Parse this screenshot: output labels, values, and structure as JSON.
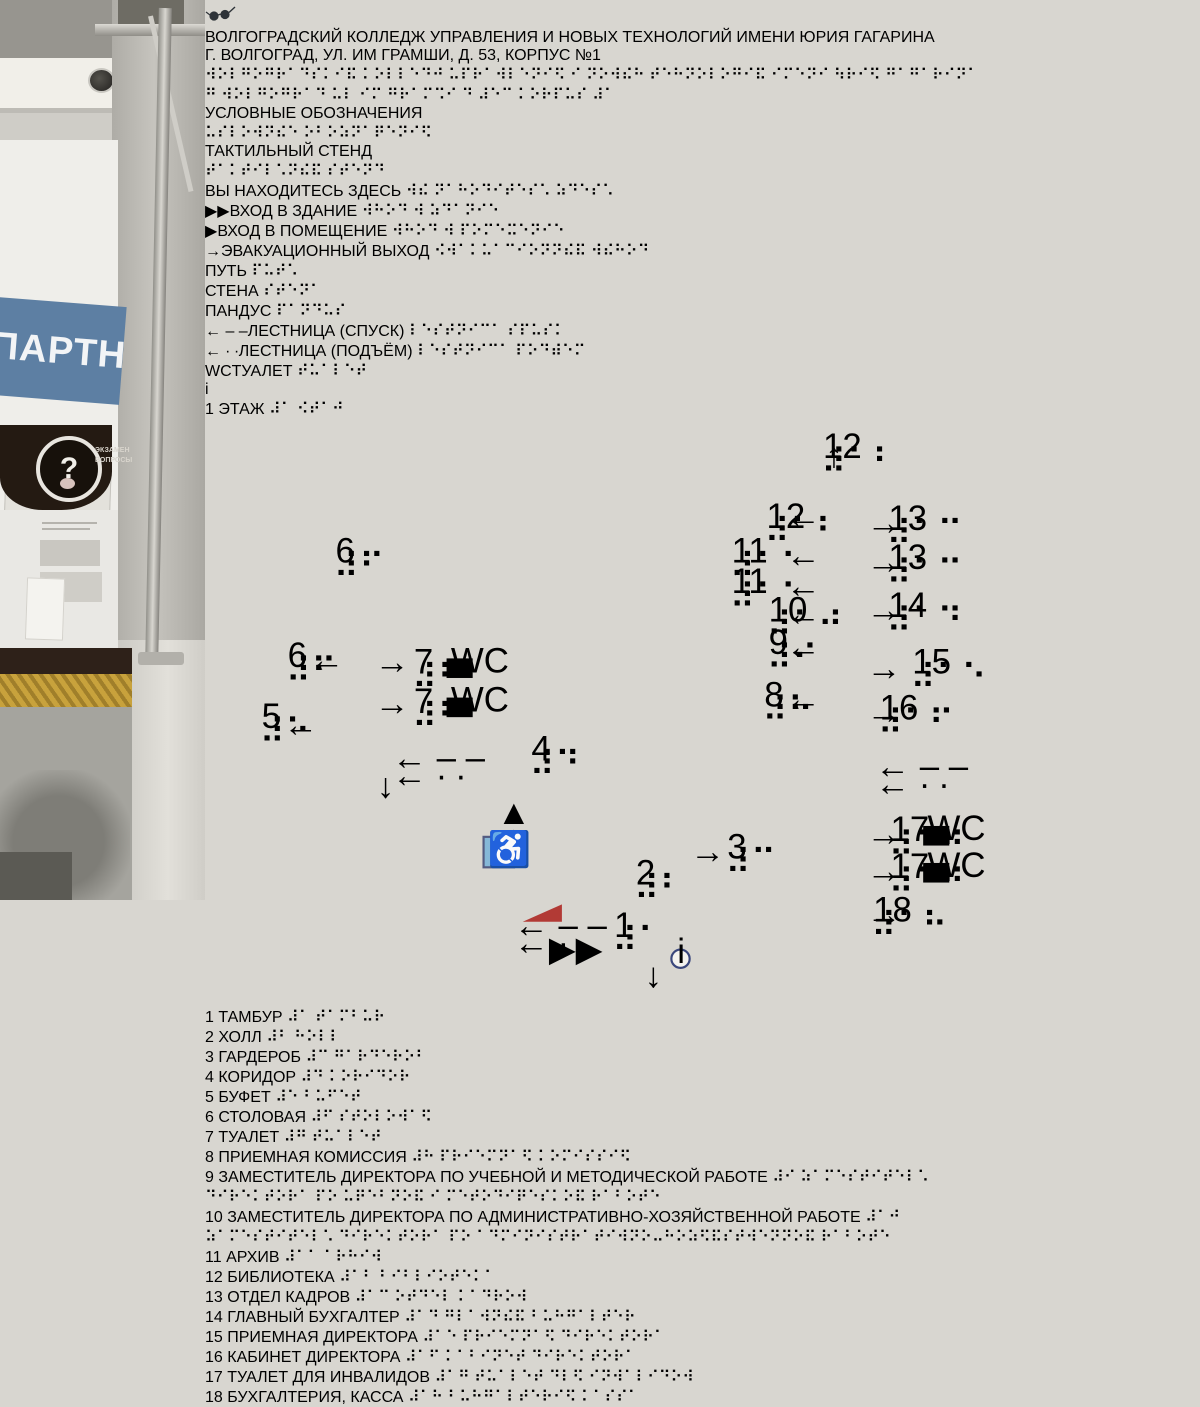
{
  "scene": {
    "partner_title": "ПАРТНЕРЫ",
    "partner_sub": "«ВГАЗ-СУАЛ» АО «СУАЛ»",
    "qmark": "?",
    "exam_line1": "ЭКЗАМЕН",
    "exam_line2": "ВОПРОСЫ"
  },
  "sign": {
    "colors": {
      "accent_red": "#b0362f",
      "navy": "#3a477c",
      "path_red": "#b23a35"
    },
    "title_line1": "ВОЛГОГРАДСКИЙ КОЛЛЕДЖ УПРАВЛЕНИЯ И НОВЫХ ТЕХНОЛОГИЙ ИМЕНИ ЮРИЯ ГАГАРИНА",
    "title_line2": "Г. ВОЛГОГРАД, УЛ. ИМ ГРАМШИ, Д. 53, КОРПУС №1",
    "title_braille1": "⠺⠕⠇⠛⠕⠛⠗⠁⠙⠎⠅⠊⠯ ⠅⠕⠇⠇⠑⠙⠚ ⠥⠏⠗⠁⠺⠇⠑⠝⠊⠫ ⠊ ⠝⠕⠺⠮⠓ ⠞⠑⠓⠝⠕⠇⠕⠛⠊⠯ ⠊⠍⠑⠝⠊ ⠳⠗⠊⠫ ⠛⠁⠛⠁⠗⠊⠝⠁",
    "title_braille2": "⠛ ⠺⠕⠇⠛⠕⠛⠗⠁⠙ ⠥⠇ ⠊⠍ ⠛⠗⠁⠍⠩⠊ ⠙ ⠼⠑⠉ ⠅⠕⠗⠏⠥⠎ ⠼⠁",
    "legend": {
      "heading": "УСЛОВНЫЕ ОБОЗНАЧЕНИЯ",
      "heading_braille": "⠥⠎⠇⠕⠺⠝⠮⠑ ⠕⠃⠕⠵⠝⠁⠟⠑⠝⠊⠫",
      "stand_label": "ТАКТИЛЬНЫЙ СТЕНД",
      "stand_braille": "⠞⠁⠅⠞⠊⠇⠡⠝⠮⠯ ⠎⠞⠑⠝⠙",
      "info_glyph": "i",
      "items": [
        {
          "cls": "ty-none",
          "icon": "",
          "label": "ВЫ НАХОДИТЕСЬ ЗДЕСЬ",
          "braille": "⠺⠮ ⠝⠁⠓⠕⠙⠊⠞⠑⠎⠡ ⠵⠙⠑⠎⠡"
        },
        {
          "cls": "ty-red",
          "icon": "▶▶",
          "label": "ВХОД В ЗДАНИЕ",
          "braille": "⠺⠓⠕⠙ ⠺ ⠵⠙⠁⠝⠊⠑"
        },
        {
          "cls": "ty-red",
          "icon": "▶",
          "label": "ВХОД В ПОМЕЩЕНИЕ",
          "braille": "⠺⠓⠕⠙ ⠺ ⠏⠕⠍⠑⠭⠑⠝⠊⠑"
        },
        {
          "cls": "ty-red",
          "icon": "→",
          "label": "ЭВАКУАЦИОННЫЙ ВЫХОД",
          "braille": "⠪⠺⠁⠅⠥⠁⠉⠊⠕⠝⠝⠮⠯ ⠺⠮⠓⠕⠙"
        },
        {
          "cls": "ty-dash inl",
          "icon": "",
          "label": "ПУТЬ",
          "braille": "⠏⠥⠞⠡"
        },
        {
          "cls": "ty-wall inl",
          "icon": "",
          "label": "СТЕНА",
          "braille": "⠎⠞⠑⠝⠁"
        },
        {
          "cls": "ty-ramp inl",
          "icon": "",
          "label": "ПАНДУС",
          "braille": "⠏⠁⠝⠙⠥⠎"
        },
        {
          "cls": "ty-navy",
          "icon": "← – –",
          "label": "ЛЕСТНИЦА (СПУСК)",
          "braille": "⠇⠑⠎⠞⠝⠊⠉⠁ ⠎⠏⠥⠎⠅"
        },
        {
          "cls": "ty-navy",
          "icon": "← ∙ ∙",
          "label": "ЛЕСТНИЦА (ПОДЪЁМ)",
          "braille": "⠇⠑⠎⠞⠝⠊⠉⠁ ⠏⠕⠙⠾⠑⠍"
        },
        {
          "cls": "ty-wc inl",
          "icon": "WC",
          "label": "ТУАЛЕТ",
          "braille": "⠞⠥⠁⠇⠑⠞"
        }
      ]
    },
    "plan": {
      "title": "1 ЭТАЖ",
      "title_braille": "⠼⠁ ⠪⠞⠁⠚",
      "wc": "WC",
      "rooms": [
        {
          "n": "6",
          "b": "⠼⠋",
          "x": 60,
          "y": 66
        },
        {
          "n": "6",
          "b": "⠼⠋",
          "x": 38,
          "y": 114
        },
        {
          "n": "5",
          "b": "⠼⠑",
          "x": 26,
          "y": 142
        },
        {
          "n": "7",
          "b": "⠼⠛",
          "x": 96,
          "y": 117,
          "wc": 1
        },
        {
          "n": "7",
          "b": "⠼⠛",
          "x": 96,
          "y": 135,
          "wc": 1
        },
        {
          "n": "4",
          "b": "⠼⠙",
          "x": 150,
          "y": 157
        },
        {
          "n": "3",
          "b": "⠼⠉",
          "x": 240,
          "y": 202
        },
        {
          "n": "2",
          "b": "⠼⠃",
          "x": 198,
          "y": 214
        },
        {
          "n": "1",
          "b": "⠼⠁",
          "x": 188,
          "y": 238
        },
        {
          "n": "12",
          "b": "⠼⠁⠃",
          "x": 284,
          "y": 18
        },
        {
          "n": "12",
          "b": "⠼⠁⠃",
          "x": 258,
          "y": 50
        },
        {
          "n": "11",
          "b": "⠼⠁⠁",
          "x": 242,
          "y": 66
        },
        {
          "n": "11",
          "b": "⠼⠁⠁",
          "x": 242,
          "y": 80
        },
        {
          "n": "10",
          "b": "⠼⠁⠚",
          "x": 259,
          "y": 93
        },
        {
          "n": "9",
          "b": "⠼⠊",
          "x": 259,
          "y": 108
        },
        {
          "n": "8",
          "b": "⠼⠓",
          "x": 257,
          "y": 132
        },
        {
          "n": "13",
          "b": "⠼⠁⠉",
          "x": 314,
          "y": 51
        },
        {
          "n": "13",
          "b": "⠼⠁⠉",
          "x": 314,
          "y": 69
        },
        {
          "n": "14",
          "b": "⠼⠁⠙",
          "x": 314,
          "y": 91
        },
        {
          "n": "15",
          "b": "⠼⠁⠑",
          "x": 325,
          "y": 117
        },
        {
          "n": "16",
          "b": "⠼⠁⠋",
          "x": 310,
          "y": 138
        },
        {
          "n": "17",
          "b": "⠼⠁⠛",
          "x": 315,
          "y": 194,
          "wc": 1
        },
        {
          "n": "17",
          "b": "⠼⠁⠛",
          "x": 315,
          "y": 211,
          "wc": 1
        },
        {
          "n": "18",
          "b": "⠼⠁⠓",
          "x": 307,
          "y": 231
        }
      ],
      "marks": [
        {
          "t": "→",
          "x": 78,
          "y": 117,
          "cls": "pl-red"
        },
        {
          "t": "→",
          "x": 78,
          "y": 136,
          "cls": "pl-red"
        },
        {
          "t": "←",
          "x": 48,
          "y": 116,
          "cls": "pl-red"
        },
        {
          "t": "←",
          "x": 36,
          "y": 146,
          "cls": "pl-red"
        },
        {
          "t": "←",
          "x": 267,
          "y": 50,
          "cls": "pl-red"
        },
        {
          "t": "←",
          "x": 267,
          "y": 68,
          "cls": "pl-red"
        },
        {
          "t": "←",
          "x": 267,
          "y": 82,
          "cls": "pl-red"
        },
        {
          "t": "←",
          "x": 267,
          "y": 95,
          "cls": "pl-red"
        },
        {
          "t": "←",
          "x": 267,
          "y": 110,
          "cls": "pl-red"
        },
        {
          "t": "←",
          "x": 267,
          "y": 134,
          "cls": "pl-red"
        },
        {
          "t": "→",
          "x": 304,
          "y": 53,
          "cls": "pl-red"
        },
        {
          "t": "→",
          "x": 304,
          "y": 71,
          "cls": "pl-red"
        },
        {
          "t": "→",
          "x": 304,
          "y": 93,
          "cls": "pl-red"
        },
        {
          "t": "→",
          "x": 304,
          "y": 120,
          "cls": "pl-red"
        },
        {
          "t": "→",
          "x": 304,
          "y": 140,
          "cls": "pl-red"
        },
        {
          "t": "→",
          "x": 304,
          "y": 196,
          "cls": "pl-red"
        },
        {
          "t": "→",
          "x": 304,
          "y": 213,
          "cls": "pl-red"
        },
        {
          "t": "→",
          "x": 304,
          "y": 233,
          "cls": "pl-red"
        },
        {
          "t": "↑",
          "x": 285,
          "y": 22,
          "cls": "pl-red"
        },
        {
          "t": "▲",
          "x": 134,
          "y": 186,
          "cls": "pl-red"
        },
        {
          "t": "▲",
          "x": 134,
          "y": 198,
          "cls": "pl-red"
        },
        {
          "t": "→",
          "x": 223,
          "y": 204,
          "cls": "pl-red"
        },
        {
          "t": "▶▶",
          "x": 158,
          "y": 249,
          "cls": "pl-red"
        },
        {
          "t": "← – –",
          "x": 86,
          "y": 161,
          "cls": "pl-mk"
        },
        {
          "t": "← ∙ ∙",
          "x": 86,
          "y": 169,
          "cls": "pl-mk"
        },
        {
          "t": "← – –",
          "x": 308,
          "y": 165,
          "cls": "pl-mk"
        },
        {
          "t": "← ∙ ∙",
          "x": 308,
          "y": 173,
          "cls": "pl-mk"
        },
        {
          "t": "← – –",
          "x": 142,
          "y": 238,
          "cls": "pl-mk"
        },
        {
          "t": "← ∙ ∙",
          "x": 142,
          "y": 246,
          "cls": "pl-mk"
        },
        {
          "t": "↓",
          "x": 79,
          "y": 174,
          "cls": "pl-mk"
        },
        {
          "t": "↓",
          "x": 202,
          "y": 261,
          "cls": "pl-mk"
        },
        {
          "t": "i",
          "x": 217,
          "y": 250,
          "cls": "pl-info-t"
        },
        {
          "t": "♿",
          "x": 130,
          "y": 203,
          "cls": "pl-wh"
        }
      ]
    },
    "rooms": {
      "col1": [
        {
          "n": "1",
          "l1": "ТАМБУР",
          "l2": "",
          "b1": "⠼⠁ ⠞⠁⠍⠃⠥⠗",
          "b2": ""
        },
        {
          "n": "2",
          "l1": "ХОЛЛ",
          "l2": "",
          "b1": "⠼⠃ ⠓⠕⠇⠇",
          "b2": ""
        },
        {
          "n": "3",
          "l1": "ГАРДЕРОБ",
          "l2": "",
          "b1": "⠼⠉ ⠛⠁⠗⠙⠑⠗⠕⠃",
          "b2": ""
        },
        {
          "n": "4",
          "l1": "КОРИДОР",
          "l2": "",
          "b1": "⠼⠙ ⠅⠕⠗⠊⠙⠕⠗",
          "b2": ""
        },
        {
          "n": "5",
          "l1": "БУФЕТ",
          "l2": "",
          "b1": "⠼⠑ ⠃⠥⠋⠑⠞",
          "b2": ""
        },
        {
          "n": "6",
          "l1": "СТОЛОВАЯ",
          "l2": "",
          "b1": "⠼⠋ ⠎⠞⠕⠇⠕⠺⠁⠫",
          "b2": ""
        },
        {
          "n": "7",
          "l1": "ТУАЛЕТ",
          "l2": "",
          "b1": "⠼⠛ ⠞⠥⠁⠇⠑⠞",
          "b2": ""
        }
      ],
      "col2": [
        {
          "n": "8",
          "l1": "ПРИЕМНАЯ КОМИССИЯ",
          "l2": "",
          "b1": "⠼⠓ ⠏⠗⠊⠑⠍⠝⠁⠫ ⠅⠕⠍⠊⠎⠎⠊⠫",
          "b2": ""
        },
        {
          "n": "9",
          "l1": "ЗАМЕСТИТЕЛЬ ДИРЕКТОРА",
          "l2": "ПО УЧЕБНОЙ И МЕТОДИЧЕСКОЙ РАБОТЕ",
          "b1": "⠼⠊ ⠵⠁⠍⠑⠎⠞⠊⠞⠑⠇⠡ ⠙⠊⠗⠑⠅⠞⠕⠗⠁",
          "b2": "⠏⠕ ⠥⠟⠑⠃⠝⠕⠯ ⠊ ⠍⠑⠞⠕⠙⠊⠟⠑⠎⠅⠕⠯ ⠗⠁⠃⠕⠞⠑"
        },
        {
          "n": "10",
          "l1": "ЗАМЕСТИТЕЛЬ ДИРЕКТОРА",
          "l2": "ПО АДМИНИСТРАТИВНО-ХОЗЯЙСТВЕННОЙ РАБОТЕ",
          "b1": "⠼⠁⠚ ⠵⠁⠍⠑⠎⠞⠊⠞⠑⠇⠡ ⠙⠊⠗⠑⠅⠞⠕⠗⠁",
          "b2": "⠏⠕ ⠁⠙⠍⠊⠝⠊⠎⠞⠗⠁⠞⠊⠺⠝⠕⠤⠓⠕⠵⠫⠯⠎⠞⠺⠑⠝⠝⠕⠯ ⠗⠁⠃⠕⠞⠑"
        },
        {
          "n": "11",
          "l1": "АРХИВ",
          "l2": "",
          "b1": "⠼⠁⠁ ⠁⠗⠓⠊⠺",
          "b2": ""
        },
        {
          "n": "12",
          "l1": "БИБЛИОТЕКА",
          "l2": "",
          "b1": "⠼⠁⠃ ⠃⠊⠃⠇⠊⠕⠞⠑⠅⠁",
          "b2": ""
        }
      ],
      "col3": [
        {
          "n": "13",
          "l1": "ОТДЕЛ КАДРОВ",
          "l2": "",
          "b1": "⠼⠁⠉ ⠕⠞⠙⠑⠇ ⠅⠁⠙⠗⠕⠺",
          "b2": ""
        },
        {
          "n": "14",
          "l1": "ГЛАВНЫЙ БУХГАЛТЕР",
          "l2": "",
          "b1": "⠼⠁⠙ ⠛⠇⠁⠺⠝⠮⠯ ⠃⠥⠓⠛⠁⠇⠞⠑⠗",
          "b2": ""
        },
        {
          "n": "15",
          "l1": "ПРИЕМНАЯ ДИРЕКТОРА",
          "l2": "",
          "b1": "⠼⠁⠑ ⠏⠗⠊⠑⠍⠝⠁⠫ ⠙⠊⠗⠑⠅⠞⠕⠗⠁",
          "b2": ""
        },
        {
          "n": "16",
          "l1": "КАБИНЕТ ДИРЕКТОРА",
          "l2": "",
          "b1": "⠼⠁⠋ ⠅⠁⠃⠊⠝⠑⠞ ⠙⠊⠗⠑⠅⠞⠕⠗⠁",
          "b2": ""
        }
      ],
      "col4": [
        {
          "n": "17",
          "l1": "ТУАЛЕТ ДЛЯ",
          "l2": "ИНВАЛИДОВ",
          "b1": "⠼⠁⠛ ⠞⠥⠁⠇⠑⠞ ⠙⠇⠫",
          "b2": "⠊⠝⠺⠁⠇⠊⠙⠕⠺"
        },
        {
          "n": "18",
          "l1": "БУХГАЛТЕРИЯ,",
          "l2": "КАССА",
          "b1": "⠼⠁⠓ ⠃⠥⠓⠛⠁⠇⠞⠑⠗⠊⠫",
          "b2": "⠅⠁⠎⠎⠁"
        }
      ]
    }
  }
}
